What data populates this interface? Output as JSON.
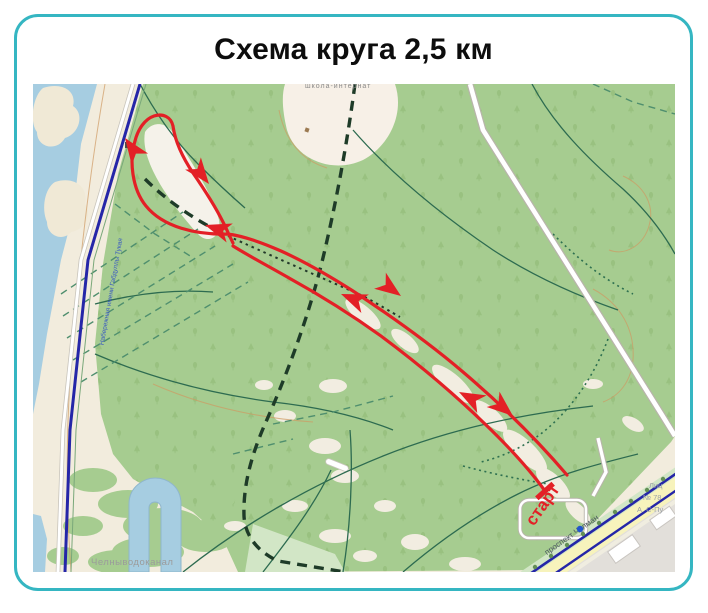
{
  "card": {
    "title": "Схема круга 2,5 км",
    "border_color": "#35b6c2"
  },
  "map": {
    "route": {
      "start_label": "старт",
      "color": "#e32026"
    },
    "labels": {
      "waterworks": "Челныводоканал",
      "avenue": "проспект Чулман",
      "embankment": "Набережная имени Габдуллы Тукая",
      "school_clipped": "школа-интернат",
      "lyceum_line1": "Лиц",
      "lyceum_line2": "№ 78",
      "lyceum_line3": "А. С-Пу"
    },
    "colors": {
      "forest": "#a6cc90",
      "water": "#a6cde1",
      "sand": "#f2ecdd",
      "clearing": "#f2ede1",
      "road_blue": "#2526a8",
      "avenue_yellow": "#f7f3bc",
      "urban": "#e2dfda",
      "trail_green": "#2d6b50"
    }
  }
}
